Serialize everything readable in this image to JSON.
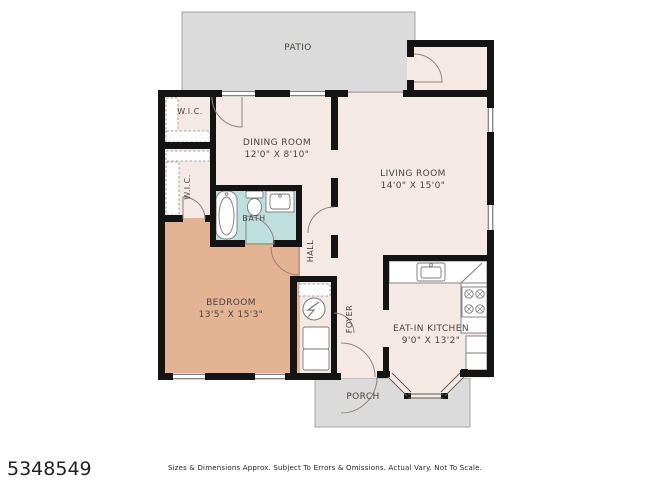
{
  "colors": {
    "wall": "#141414",
    "floor": "#f4e9e5",
    "bedroom": "#e3b394",
    "bath": "#bfdfdf",
    "outdoor": "#dbdbdb",
    "label": "#4b4340",
    "line": "#7a7a7a"
  },
  "rooms": {
    "patio": {
      "label": "PATIO"
    },
    "wic_upper": {
      "label": "W.I.C."
    },
    "wic_lower": {
      "label": "W.I.C."
    },
    "dining": {
      "label": "DINING ROOM",
      "dims": "12'0\" X 8'10\""
    },
    "living": {
      "label": "LIVING ROOM",
      "dims": "14'0\" X 15'0\""
    },
    "bath": {
      "label": "BATH"
    },
    "hall": {
      "label": "HALL"
    },
    "bedroom": {
      "label": "BEDROOM",
      "dims": "13'5\" X 15'3\""
    },
    "foyer": {
      "label": "FOYER"
    },
    "kitchen": {
      "label": "EAT-IN KITCHEN",
      "dims": "9'0\" X 13'2\""
    },
    "porch": {
      "label": "PORCH"
    }
  },
  "fixtures": [
    "bathtub",
    "toilet",
    "bathroom-sink",
    "kitchen-sink",
    "stove",
    "washer-dryer",
    "electrical-panel",
    "closet-shelves"
  ],
  "footer": {
    "mls_number": "5348549",
    "disclaimer": "Sizes & Dimensions Approx. Subject To Errors & Omissions. Actual Vary. Not To Scale."
  }
}
